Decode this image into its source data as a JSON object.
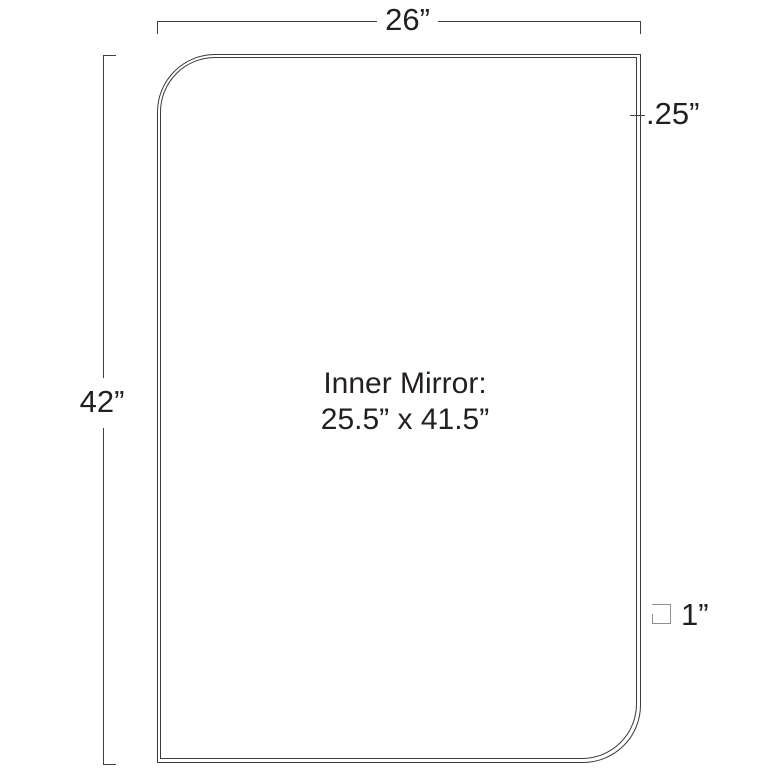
{
  "diagram": {
    "inner_mirror": {
      "line1": "Inner Mirror:",
      "line2": "25.5” x 41.5”"
    },
    "dimensions": {
      "width": "26”",
      "height": "42”",
      "frame_thickness": ".25”",
      "corner": "1”"
    },
    "colors": {
      "line": "#3f3f3f",
      "outline": "#3a3a3a",
      "text": "#231f20",
      "marker": "#8e8e8e",
      "background": "#ffffff"
    }
  }
}
